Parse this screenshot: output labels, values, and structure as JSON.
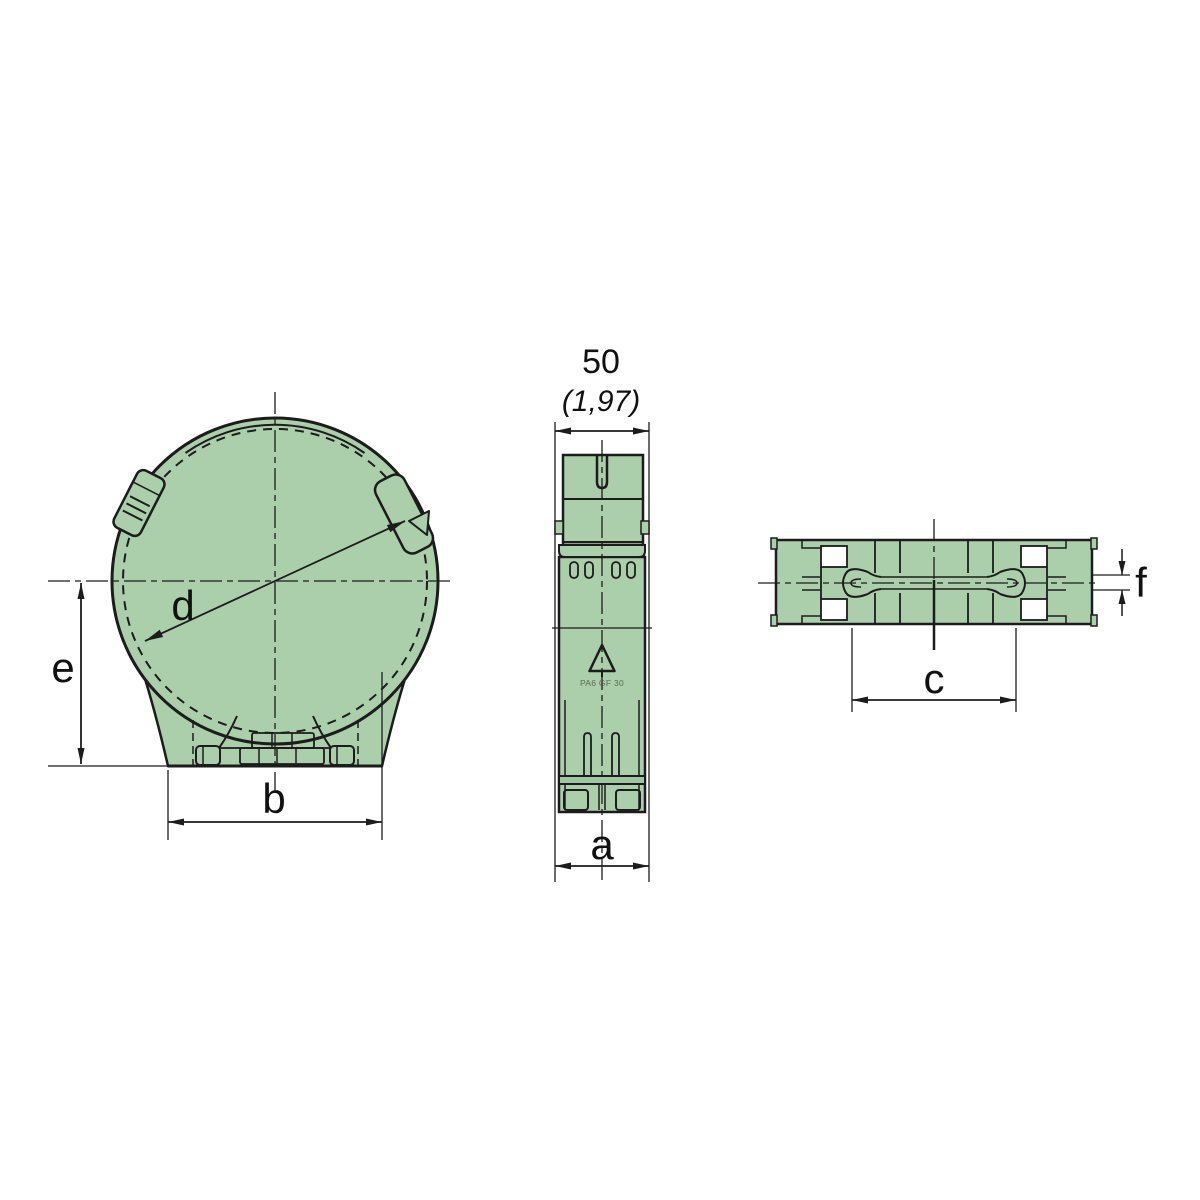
{
  "drawing": {
    "type": "technical-drawing",
    "colors": {
      "body_fill": "#abceab",
      "shade_fill": "#a0c5a2",
      "line": "#1c1c1c",
      "background": "#ffffff"
    },
    "dims": {
      "width_mm": "50",
      "width_in": "(1,97)",
      "a": "a",
      "b": "b",
      "c": "c",
      "d": "d",
      "e": "e",
      "f": "f"
    },
    "material": {
      "icon": "recycling-triangle-icon",
      "text": "PA6 GF 30"
    }
  }
}
